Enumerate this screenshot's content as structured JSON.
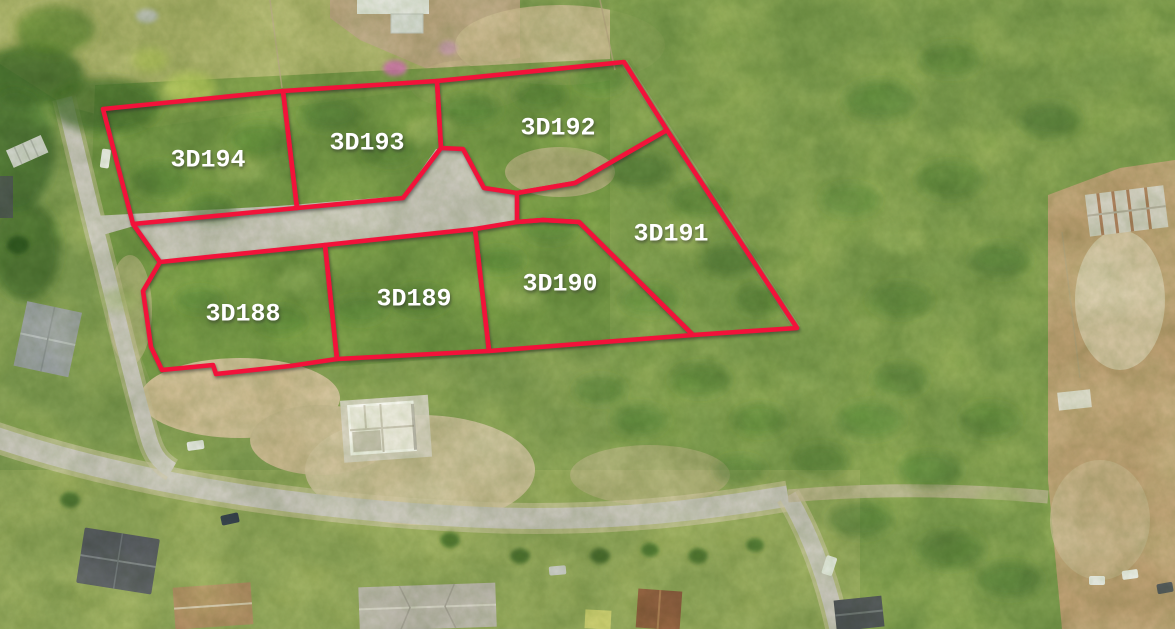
{
  "scene": {
    "description": "Aerial drone photograph of a subdivision with seven land parcels outlined in red",
    "overlay_color": "#f2123a",
    "label_color": "#ffffff"
  },
  "parcels": [
    {
      "label": "3D194",
      "label_x": 208,
      "label_y": 160,
      "points": "103,109 283,91 297,208 133,224"
    },
    {
      "label": "3D193",
      "label_x": 367,
      "label_y": 143,
      "points": "283,91 437,81 441,148 403,198 297,208"
    },
    {
      "label": "3D192",
      "label_x": 558,
      "label_y": 128,
      "points": "437,81 624,62 667,130 575,183 517,193 484,188 463,149 441,148"
    },
    {
      "label": "3D191",
      "label_x": 671,
      "label_y": 234,
      "points": "667,130 797,328 693,335 579,222 543,220 517,222 517,193 575,183"
    },
    {
      "label": "3D190",
      "label_x": 560,
      "label_y": 284,
      "points": "475,229 517,222 543,220 579,222 693,335 489,351"
    },
    {
      "label": "3D189",
      "label_x": 414,
      "label_y": 299,
      "points": "325,245 475,229 489,351 337,359"
    },
    {
      "label": "3D188",
      "label_x": 243,
      "label_y": 314,
      "points": "160,262 325,245 337,359 290,366 216,374 213,365 162,370 151,347 143,291"
    }
  ],
  "extra_segments": [
    {
      "name": "road-edge-connector",
      "points": "133,224 160,262"
    }
  ]
}
